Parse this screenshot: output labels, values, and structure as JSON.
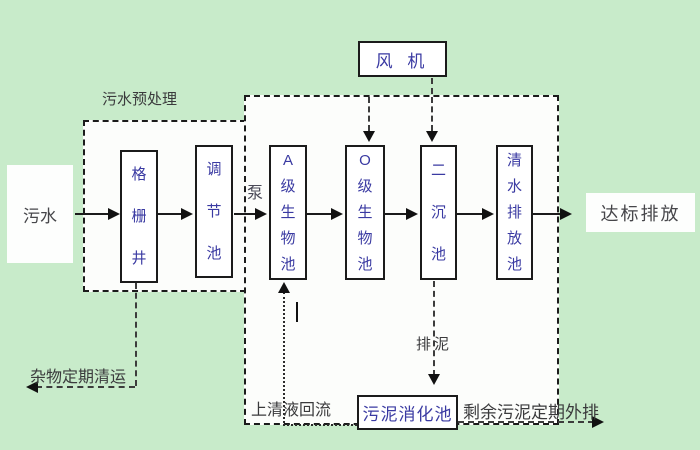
{
  "colors": {
    "background": "#c8ebca",
    "group_fill": "#fcfdfb",
    "tank_text": "#3a3aa2",
    "shadow": "#8b8b8b",
    "label_text": "#3a3a3c",
    "line": "#1b1b1b"
  },
  "groups": {
    "pretreatment_label": "污水预处理"
  },
  "endpoints": {
    "source_label": "污水",
    "discharge_label": "达标排放"
  },
  "blower": {
    "label": "风 机"
  },
  "pump_label": "泵",
  "process_tanks": [
    {
      "id": "grid-well",
      "label": "格栅井"
    },
    {
      "id": "regulating-tank",
      "label": "调节池"
    },
    {
      "id": "a-bio-tank",
      "label": "A级生物池"
    },
    {
      "id": "o-bio-tank",
      "label": "O级生物池"
    },
    {
      "id": "secondary-sedimentation-tank",
      "label": "二沉池"
    },
    {
      "id": "clear-water-discharge-tank",
      "label": "清水排放池"
    }
  ],
  "sludge_tank": {
    "label": "污泥消化池"
  },
  "flow_labels": {
    "debris_removal": "杂物定期清运",
    "supernatant_return": "上清液回流",
    "sludge_discharge": "排泥",
    "excess_sludge_out": "剩余污泥定期外排"
  }
}
